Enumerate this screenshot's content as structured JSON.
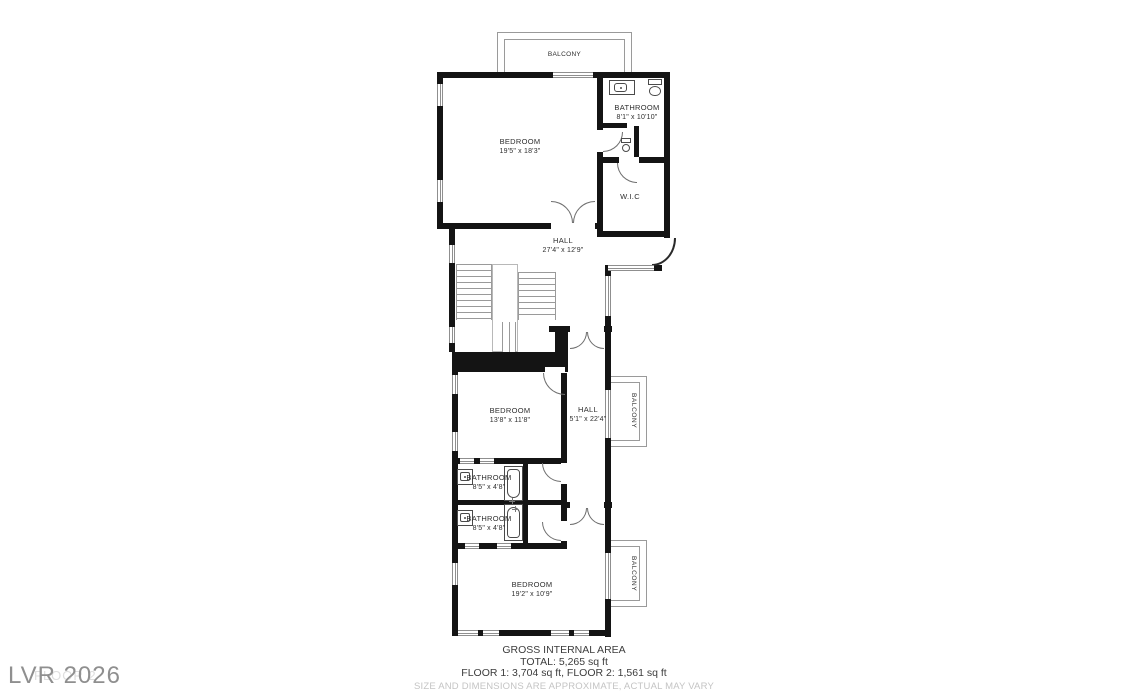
{
  "watermark": {
    "brand": "LVR 2026",
    "floor_label": "FLOOR 2"
  },
  "rooms": {
    "balcony_top": {
      "name": "BALCONY"
    },
    "bedroom1": {
      "name": "BEDROOM",
      "dims": "19'5\" x 18'3\""
    },
    "bathroom1": {
      "name": "BATHROOM",
      "dims": "8'1\" x 10'10\""
    },
    "wic": {
      "name": "W.I.C"
    },
    "hall1": {
      "name": "HALL",
      "dims": "27'4\" x 12'9\""
    },
    "bedroom2": {
      "name": "BEDROOM",
      "dims": "13'8\" x 11'8\""
    },
    "hall2": {
      "name": "HALL",
      "dims": "5'1\" x 22'4\""
    },
    "balcony_mid": {
      "name": "BALCONY"
    },
    "bathroom2": {
      "name": "BATHROOM",
      "dims": "8'5\" x 4'8\""
    },
    "bathroom3": {
      "name": "BATHROOM",
      "dims": "8'5\" x 4'8\""
    },
    "bedroom3": {
      "name": "BEDROOM",
      "dims": "19'2\" x 10'9\""
    },
    "balcony_bottom": {
      "name": "BALCONY"
    }
  },
  "footer": {
    "title": "GROSS INTERNAL AREA",
    "total": "TOTAL: 5,265 sq ft",
    "floors": "FLOOR 1: 3,704 sq ft, FLOOR 2: 1,561 sq ft",
    "disclaimer": "SIZE AND DIMENSIONS ARE APPROXIMATE, ACTUAL MAY VARY"
  },
  "colors": {
    "wall": "#141414",
    "window_line": "#8f8f8f",
    "balcony_line": "#9a9a9a",
    "text": "#2e2e2e",
    "muted_text": "#c4c4c4",
    "watermark": "#8f8f8f"
  }
}
